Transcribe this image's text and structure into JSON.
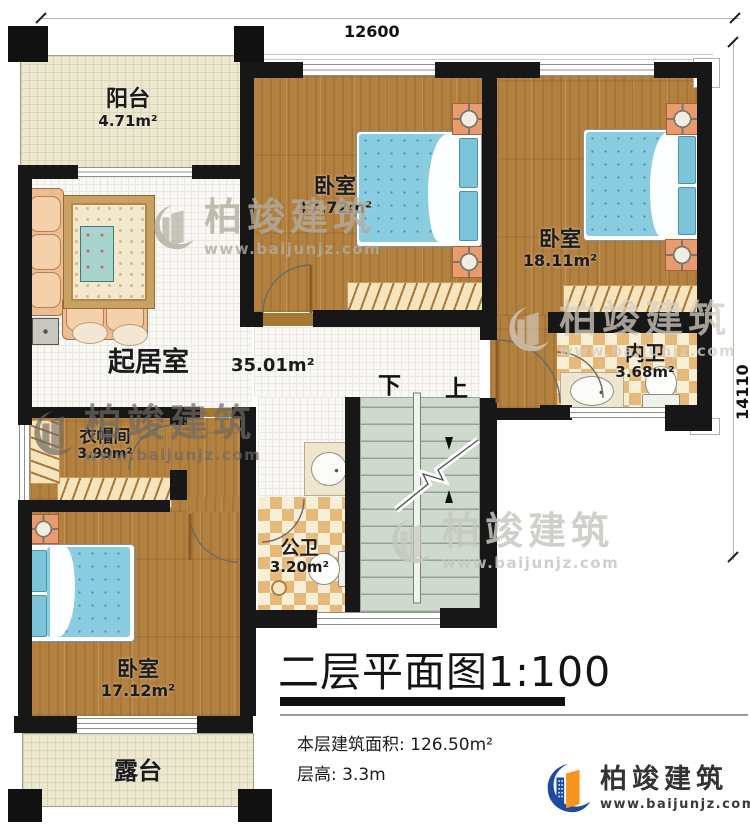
{
  "dimensions": {
    "top": "12600",
    "right": "14110"
  },
  "rooms": {
    "balcony": {
      "name": "阳台",
      "area": "4.71m²"
    },
    "bedroom_top": {
      "name": "卧室",
      "area": "17.72m²"
    },
    "bedroom_right": {
      "name": "卧室",
      "area": "18.11m²"
    },
    "ensuite_bath": {
      "name": "内卫",
      "area": "3.68m²"
    },
    "living": {
      "name": "起居室",
      "area": "35.01m²"
    },
    "cloakroom": {
      "name": "衣帽间",
      "area": "3.99m²"
    },
    "public_bath": {
      "name": "公卫",
      "area": "3.20m²"
    },
    "bedroom_bottom": {
      "name": "卧室",
      "area": "17.12m²"
    },
    "terrace": {
      "name": "露台"
    }
  },
  "stairs": {
    "down_label": "下",
    "up_label": "上"
  },
  "title_block": {
    "title": "二层平面图1:100",
    "floor_area": "本层建筑面积: 126.50m²",
    "floor_height": "层高: 3.3m"
  },
  "branding": {
    "name": "柏竣建筑",
    "website": "www.baijunjz.com"
  },
  "colors": {
    "wall": "#171717",
    "wood_floor": "#b2803f",
    "bed_blue": "#8bcde0",
    "tile_tan": "#e6b97b",
    "stair_green": "#cfd9cd",
    "brand_blue": "#1c4a9e",
    "brand_orange": "#f6941e"
  }
}
